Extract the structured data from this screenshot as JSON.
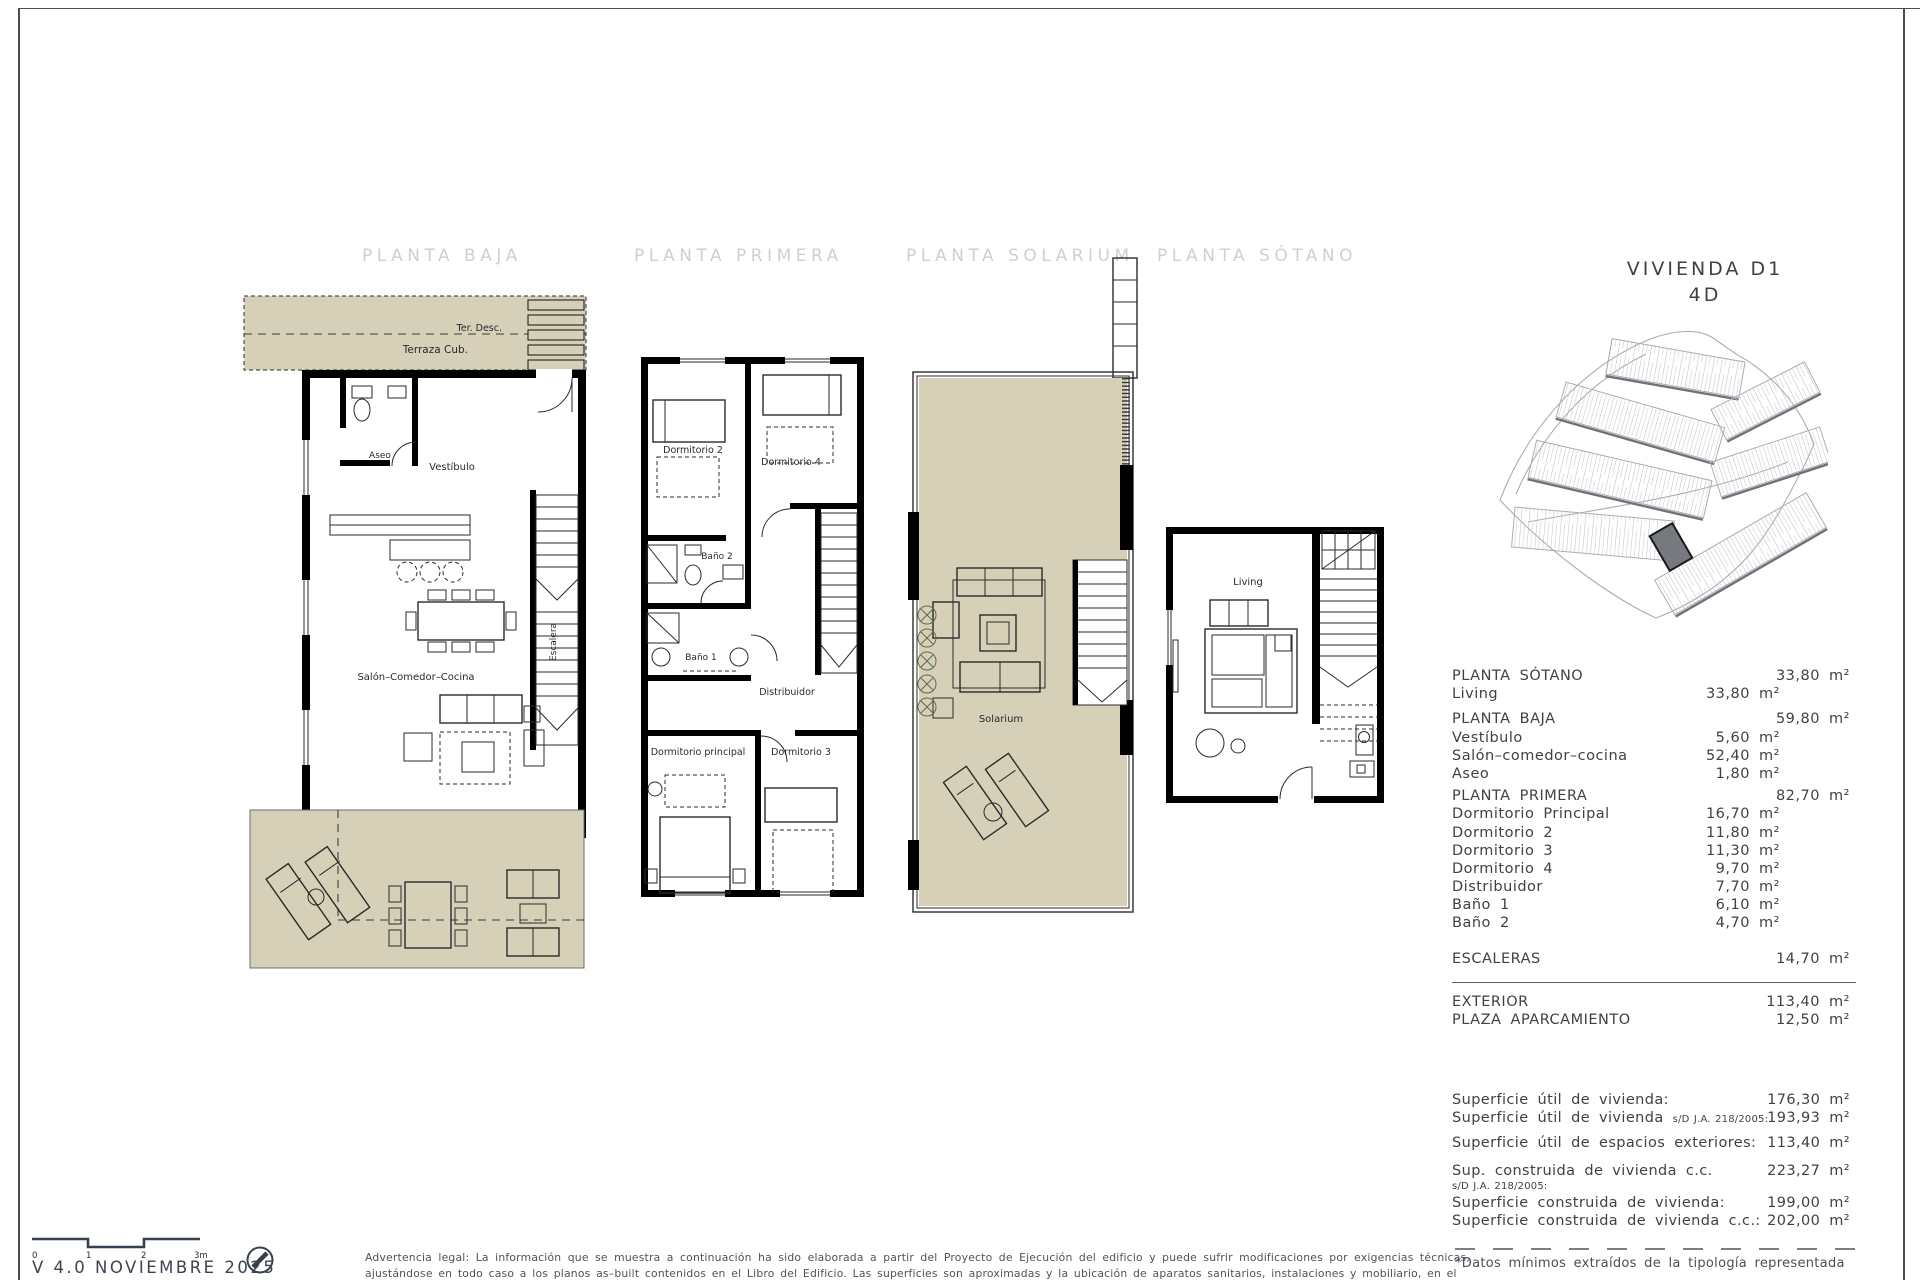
{
  "unit": {
    "title": "VIVIENDA D1",
    "subtitle": "4D"
  },
  "plans": {
    "baja": {
      "title": "PLANTA BAJA",
      "rooms": {
        "ter_desc": "Ter. Desc.",
        "terraza_cub": "Terraza Cub.",
        "aseo": "Aseo",
        "vestibulo": "Vestíbulo",
        "salon": "Salón–Comedor–Cocina",
        "escalera": "Escalera"
      }
    },
    "primera": {
      "title": "PLANTA PRIMERA",
      "rooms": {
        "dormitorio2": "Dormitorio 2",
        "dormitorio4": "Dormitorio 4",
        "bano2": "Baño 2",
        "bano1": "Baño 1",
        "distribuidor": "Distribuidor",
        "dormitorio_principal": "Dormitorio principal",
        "dormitorio3": "Dormitorio 3"
      }
    },
    "solarium": {
      "title": "PLANTA SOLARIUM",
      "rooms": {
        "solarium": "Solarium"
      }
    },
    "sotano": {
      "title": "PLANTA SÓTANO",
      "rooms": {
        "living": "Living"
      }
    }
  },
  "area_table": {
    "rows": [
      {
        "label": "PLANTA SÓTANO",
        "value": "33,80 m²",
        "level": "floor"
      },
      {
        "label": "Living",
        "value": "33,80 m²",
        "level": "room"
      },
      {
        "label": "PLANTA BAJA",
        "value": "59,80 m²",
        "level": "floor"
      },
      {
        "label": "Vestíbulo",
        "value": "5,60 m²",
        "level": "room"
      },
      {
        "label": "Salón–comedor–cocina",
        "value": "52,40 m²",
        "level": "room"
      },
      {
        "label": "Aseo",
        "value": "1,80 m²",
        "level": "room"
      },
      {
        "label": "PLANTA PRIMERA",
        "value": "82,70 m²",
        "level": "floor"
      },
      {
        "label": "Dormitorio Principal",
        "value": "16,70 m²",
        "level": "room"
      },
      {
        "label": "Dormitorio 2",
        "value": "11,80 m²",
        "level": "room"
      },
      {
        "label": "Dormitorio 3",
        "value": "11,30 m²",
        "level": "room"
      },
      {
        "label": "Dormitorio 4",
        "value": "9,70 m²",
        "level": "room"
      },
      {
        "label": "Distribuidor",
        "value": "7,70 m²",
        "level": "room"
      },
      {
        "label": "Baño 1",
        "value": "6,10 m²",
        "level": "room"
      },
      {
        "label": "Baño 2",
        "value": "4,70 m²",
        "level": "room"
      },
      {
        "label": "ESCALERAS",
        "value": "14,70 m²",
        "level": "floor"
      },
      {
        "label": "EXTERIOR",
        "value": "113,40 m²",
        "level": "floor"
      },
      {
        "label": "PLAZA APARCAMIENTO",
        "value": "12,50 m²",
        "level": "floor"
      }
    ]
  },
  "summary": {
    "rows": [
      {
        "label": "Superficie útil de vivienda:",
        "value": "176,30 m²"
      },
      {
        "label": "Superficie útil de vivienda",
        "suffix": "s/D J.A. 218/2005:",
        "value": "193,93 m²"
      },
      {
        "label": "Superficie útil de espacios exteriores:",
        "value": "113,40 m²"
      },
      {
        "label": "Sup. construida de vivienda c.c.",
        "value": "223,27 m²"
      },
      {
        "note": "s/D J.A. 218/2005:"
      },
      {
        "label": "Superficie construida de vivienda:",
        "value": "199,00 m²"
      },
      {
        "label": "Superficie construida de vivienda c.c.:",
        "value": "202,00 m²"
      }
    ],
    "footnote": "*Datos mínimos extraídos de la tipología representada"
  },
  "footer": {
    "version": "V 4.0  NOVIEMBRE 2025",
    "scale_ticks": [
      "0",
      "1",
      "2",
      "3m"
    ],
    "legal_line1": "Advertencia legal: La información que se muestra a continuación ha sido elaborada a partir del Proyecto de Ejecución del edificio y puede sufrir modificaciones por exigencias técnicas,",
    "legal_line2": "ajustándose en todo caso a los planos as–built contenidos en el Libro del Edificio. Las superficies son aproximadas y la ubicación de aparatos sanitarios, instalaciones y mobiliario, en el"
  },
  "colors": {
    "terrace_fill": "#d6d0b8",
    "accent_dark": "#35404e"
  }
}
